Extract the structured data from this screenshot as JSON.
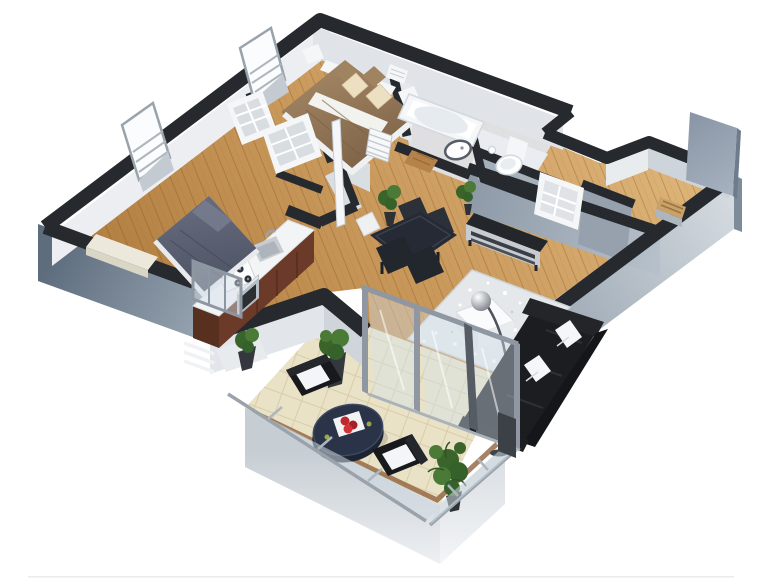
{
  "meta": {
    "title": "3D isometric cutaway floor plan of a two-bedroom apartment with balcony",
    "view": "bird's-eye axonometric from the south-east",
    "background": "#ffffff",
    "canvas": {
      "width": 768,
      "height": 582
    }
  },
  "palette": {
    "background": "#ffffff",
    "wall_top": "#26292e",
    "wall_face_outer_dark": "#5e6d7e",
    "wall_face_outer_light": "#a9b5c1",
    "inner_face_a": "#e9ecef",
    "inner_face_b": "#cdd4da",
    "hall_wall_face": "#8d99a7",
    "floor_wood_light": "#dcb277",
    "floor_wood_dark": "#ad7a3c",
    "plank_line": "rgba(122,74,24,0.30)",
    "balcony_tile": "#eae2c6",
    "tile_line": "#d8cda9",
    "deck_border": "#8a5a33",
    "glass": "rgba(213,226,235,0.42)",
    "frame_gray": "#8f98a2",
    "duvet_tan": "#8f7354",
    "pillow_cream": "#ecdfc2",
    "duvet_navy": "#575d6f",
    "cabinet_brown": "#6b3a28",
    "counter_white": "#f2f4f6",
    "appliance_steel": "#b8bec5",
    "accent_red": "#c1272d",
    "sofa_black": "#1b1d21",
    "rug_silver": "#e4e8eb",
    "table_navy": "#2a3347",
    "outdoor_wicker": "#17191d",
    "plant_green": "#4a7a36",
    "plant_green_dark": "#35612a",
    "door_panel": "#8b97a8",
    "white_fixture": "#f4f6f8",
    "steel": "#b8bec5"
  },
  "rooms": [
    {
      "id": "bedroom-1",
      "name": "Bedroom 1",
      "furniture": [
        "double bed with tan duvet",
        "cream and tan pillows",
        "white headboard shelf",
        "two white nightstands",
        "wall radiator"
      ]
    },
    {
      "id": "bedroom-2",
      "name": "Bedroom 2",
      "furniture": [
        "double bed with navy duvet",
        "white bench chest",
        "two tall framed mirrors on outer wall"
      ]
    },
    {
      "id": "closet-corridor",
      "name": "Walk-in closet corridor",
      "furniture": [
        "two open white shelving cubbies",
        "white sliding door panel"
      ]
    },
    {
      "id": "kitchen",
      "name": "Kitchen",
      "furniture": [
        "counter with white top and brown cabinets",
        "gas hob with four burners",
        "steel oven",
        "inset sink with faucet",
        "red rose on counter"
      ]
    },
    {
      "id": "dining-area",
      "name": "Dining area",
      "furniture": [
        "dark glass dining table",
        "four dark chairs",
        "one white chair",
        "potted plant"
      ]
    },
    {
      "id": "bathroom",
      "name": "Bathroom",
      "furniture": [
        "bathtub",
        "round vessel basin",
        "wooden bath mat"
      ]
    },
    {
      "id": "wc",
      "name": "WC",
      "furniture": [
        "toilet",
        "toilet-paper holder"
      ]
    },
    {
      "id": "hallway",
      "name": "Hallway",
      "furniture": [
        "dark sideboard with steel front",
        "potted plant",
        "open storage cubby"
      ]
    },
    {
      "id": "entry",
      "name": "Entry",
      "furniture": [
        "tall gray door panel",
        "shoe cabinet with wood top"
      ]
    },
    {
      "id": "living-room",
      "name": "Living room",
      "furniture": [
        "black sofa with two white pillows",
        "silver sparkle rug",
        "white coffee table",
        "chrome arc floor lamp"
      ]
    },
    {
      "id": "balcony",
      "name": "Balcony",
      "furniture": [
        "oval navy outdoor table",
        "white tray with red apples",
        "two wicker armchairs with white cushions",
        "three potted plants",
        "glass balustrade",
        "glass sliding doors"
      ]
    }
  ]
}
